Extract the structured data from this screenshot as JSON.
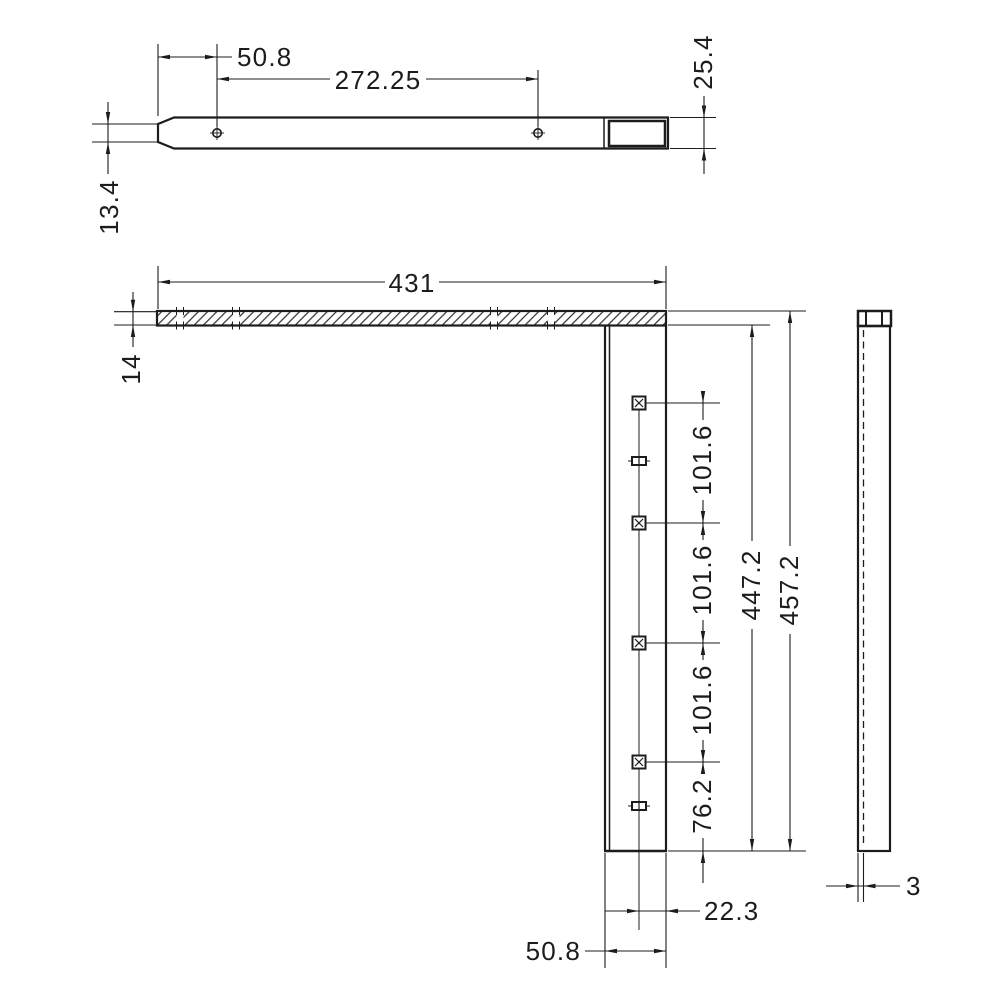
{
  "drawing": {
    "background": "#ffffff",
    "line_color": "#1c1c1c",
    "dims": {
      "top": {
        "end_height": "13.4",
        "hole_offset": "50.8",
        "hole_spacing": "272.25",
        "end_width": "25.4"
      },
      "front": {
        "length": "431",
        "plate_thickness": "14",
        "pitch_a": "101.6",
        "pitch_b": "101.6",
        "pitch_c": "101.6",
        "inner_height": "447.2",
        "outer_height": "457.2",
        "bottom_offset": "76.2",
        "edge_offset": "22.3",
        "leg_width": "50.8"
      },
      "side": {
        "thickness": "3"
      }
    }
  }
}
